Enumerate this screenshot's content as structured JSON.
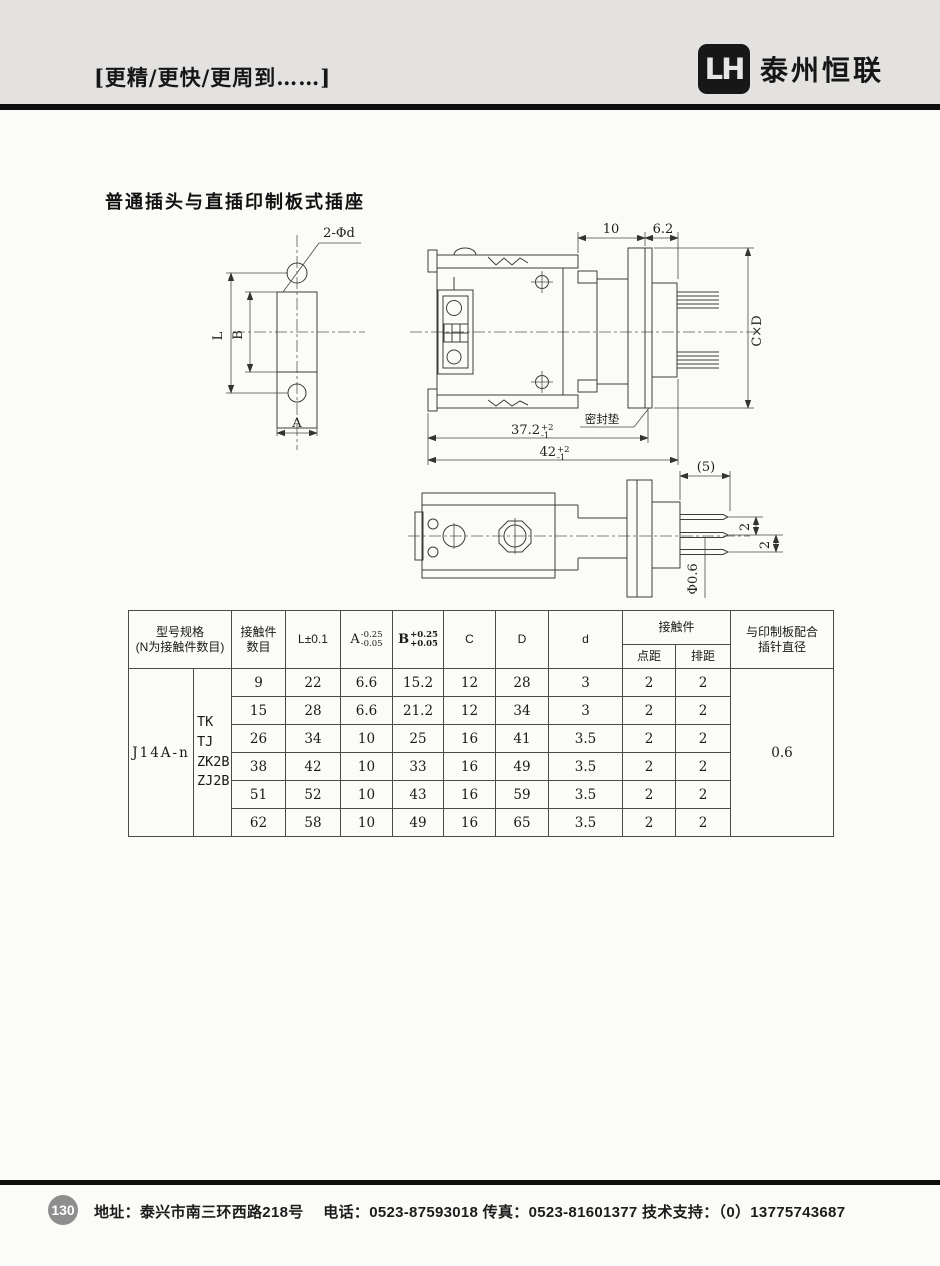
{
  "colors": {
    "header_band": "#e3e2e0",
    "rule": "#0e0e0e",
    "badge": "#8e8e8e",
    "line": "#3c3c3c"
  },
  "header": {
    "slogan": "[更精/更快/更周到……]",
    "logo_text": "LH",
    "company": "泰州恒联"
  },
  "title": "普通插头与直插印制板式插座",
  "drawing": {
    "labels": {
      "hole_callout": "2-Φd",
      "dim_L": "L",
      "dim_B": "B",
      "dim_A": "A",
      "dim_10": "10",
      "dim_6_2": "6.2",
      "dim_CxD": "C×D",
      "dim_37_2": "37.2",
      "dim_37_2_sup": "+2",
      "dim_37_2_sub": "-1",
      "dim_42": "42",
      "dim_42_sup": "+2",
      "dim_42_sub": "-1",
      "gasket": "密封垫",
      "dim_5": "(5)",
      "dim_2a": "2",
      "dim_2b": "2",
      "dim_pin": "Φ0.6"
    }
  },
  "table": {
    "headers": {
      "model_l1": "型号规格",
      "model_l2": "(N为接触件数目)",
      "contacts_l1": "接触件",
      "contacts_l2": "数目",
      "L": "L±0.1",
      "A": {
        "letter": "A",
        "sup": "-0.25",
        "sub": "-0.05"
      },
      "B": {
        "letter": "B",
        "sup": "+0.25",
        "sub": "+0.05"
      },
      "C": "C",
      "D": "D",
      "d": "d",
      "contact_group": "接触件",
      "pitch": "点距",
      "row_pitch": "排距",
      "board_l1": "与印制板配合",
      "board_l2": "插针直径"
    },
    "model": "J14A-n",
    "types": [
      "TK",
      "TJ",
      "ZK2B",
      "ZJ2B"
    ],
    "rows": [
      [
        "9",
        "22",
        "6.6",
        "15.2",
        "12",
        "28",
        "3",
        "2",
        "2"
      ],
      [
        "15",
        "28",
        "6.6",
        "21.2",
        "12",
        "34",
        "3",
        "2",
        "2"
      ],
      [
        "26",
        "34",
        "10",
        "25",
        "16",
        "41",
        "3.5",
        "2",
        "2"
      ],
      [
        "38",
        "42",
        "10",
        "33",
        "16",
        "49",
        "3.5",
        "2",
        "2"
      ],
      [
        "51",
        "52",
        "10",
        "43",
        "16",
        "59",
        "3.5",
        "2",
        "2"
      ],
      [
        "62",
        "58",
        "10",
        "49",
        "16",
        "65",
        "3.5",
        "2",
        "2"
      ]
    ],
    "pin_diameter": "0.6"
  },
  "footer": {
    "page_number": "130",
    "info": "地址：泰兴市南三环西路218号　 电话：0523-87593018  传真：0523-81601377  技术支持：（0）13775743687"
  }
}
